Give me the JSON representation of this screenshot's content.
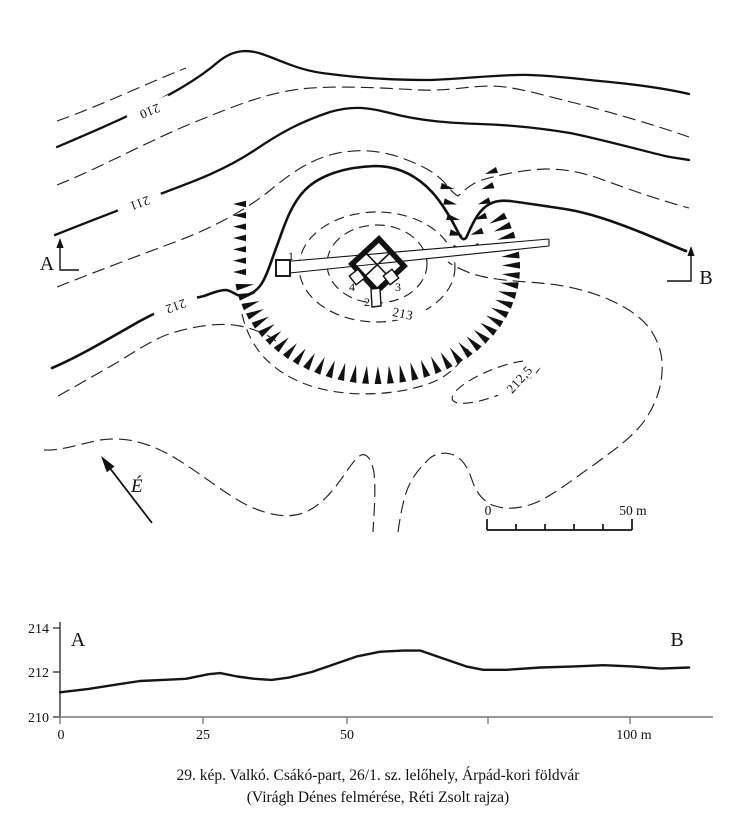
{
  "map": {
    "contour_labels": {
      "c210": "210",
      "c211": "211",
      "c212": "212",
      "c213": "213",
      "c212_5": "212,5"
    },
    "section_markers": {
      "a": "A",
      "b": "B"
    },
    "north_arrow_label": "É",
    "scale_bar": {
      "start": "0",
      "end": "50 m"
    },
    "trench_labels": {
      "t1": "1",
      "t2": "2",
      "t3": "3",
      "t4": "4"
    }
  },
  "profile": {
    "marker_a": "A",
    "marker_b": "B",
    "y_ticks": [
      "214",
      "212",
      "210"
    ],
    "x_ticks": [
      "0",
      "25",
      "50",
      "100 m"
    ],
    "chart_data": {
      "type": "line",
      "x_m": [
        0,
        5,
        10,
        14,
        18,
        22,
        26,
        28,
        31,
        34,
        37,
        40,
        44,
        48,
        52,
        56,
        60,
        63,
        67,
        71,
        74,
        78,
        84,
        90,
        95,
        100,
        105,
        110
      ],
      "elevation_m": [
        211.1,
        211.25,
        211.45,
        211.6,
        211.65,
        211.7,
        211.9,
        211.95,
        211.8,
        211.7,
        211.65,
        211.75,
        212.0,
        212.35,
        212.7,
        212.9,
        212.95,
        212.95,
        212.6,
        212.25,
        212.1,
        212.1,
        212.2,
        212.25,
        212.3,
        212.25,
        212.15,
        212.2
      ],
      "y_axis_ticks_m": [
        214,
        212,
        210
      ],
      "x_axis_ticks_m": [
        0,
        25,
        50,
        75,
        100
      ],
      "ylim": [
        210,
        214.3
      ],
      "xlim": [
        0,
        114
      ]
    }
  },
  "caption": {
    "line1": "29. kép. Valkó. Csákó-part, 26/1. sz. lelőhely, Árpád-kori földvár",
    "line2": "(Virágh Dénes felmérése, Réti Zsolt rajza)"
  }
}
